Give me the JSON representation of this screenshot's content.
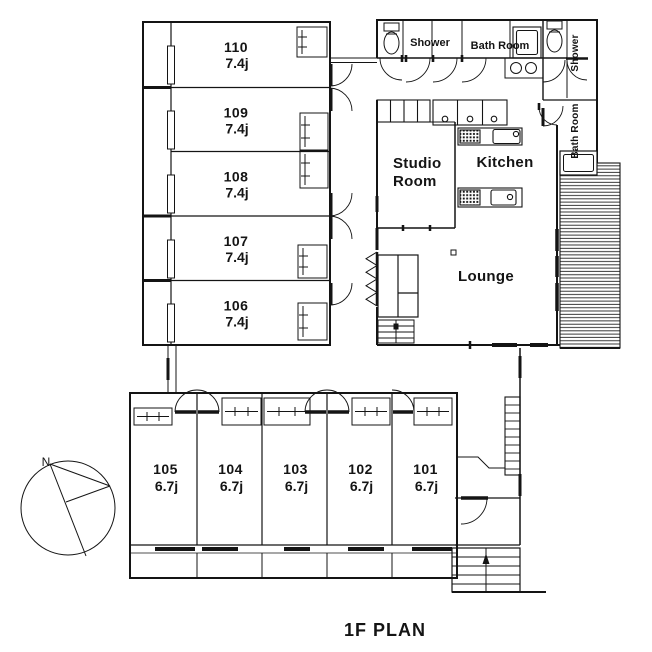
{
  "title": "1F PLAN",
  "compass": {
    "north": "N"
  },
  "upper_rooms": [
    {
      "number": "110",
      "size": "7.4j"
    },
    {
      "number": "109",
      "size": "7.4j"
    },
    {
      "number": "108",
      "size": "7.4j"
    },
    {
      "number": "107",
      "size": "7.4j"
    },
    {
      "number": "106",
      "size": "7.4j"
    }
  ],
  "lower_rooms": [
    {
      "number": "105",
      "size": "6.7j"
    },
    {
      "number": "104",
      "size": "6.7j"
    },
    {
      "number": "103",
      "size": "6.7j"
    },
    {
      "number": "102",
      "size": "6.7j"
    },
    {
      "number": "101",
      "size": "6.7j"
    }
  ],
  "labels": {
    "shower_top": "Shower",
    "bath_room_top": "Bath Room",
    "shower_side": "Shower",
    "bath_room_side": "Bath Room",
    "studio_line1": "Studio",
    "studio_line2": "Room",
    "kitchen": "Kitchen",
    "lounge": "Lounge"
  },
  "colors": {
    "line": "#141414",
    "background": "#ffffff"
  }
}
